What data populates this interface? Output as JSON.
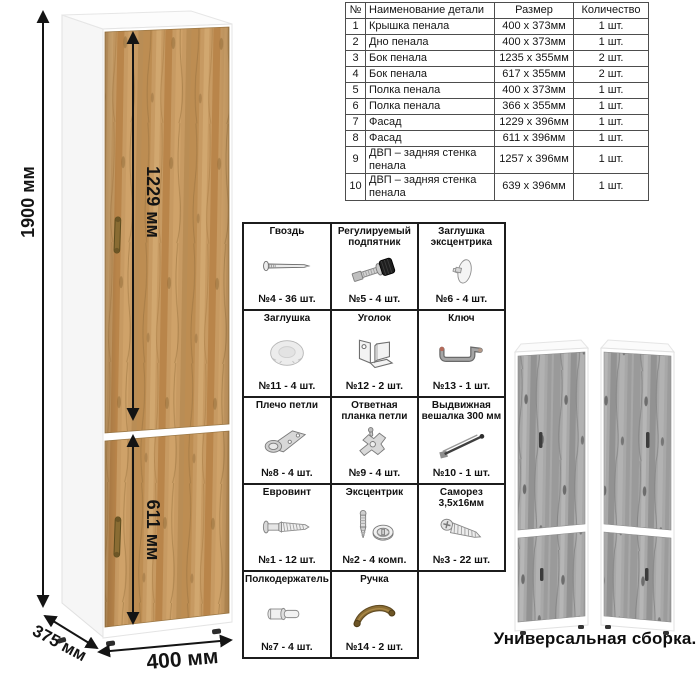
{
  "parts_table": {
    "headers": [
      "№",
      "Наименование детали",
      "Размер",
      "Количество"
    ],
    "rows": [
      [
        "1",
        "Крышка пенала",
        "400 х 373мм",
        "1 шт."
      ],
      [
        "2",
        "Дно пенала",
        "400 х 373мм",
        "1 шт."
      ],
      [
        "3",
        "Бок пенала",
        "1235 х 355мм",
        "2 шт."
      ],
      [
        "4",
        "Бок пенала",
        "617 х 355мм",
        "2 шт."
      ],
      [
        "5",
        "Полка пенала",
        "400 х 373мм",
        "1 шт."
      ],
      [
        "6",
        "Полка пенала",
        "366 х 355мм",
        "1 шт."
      ],
      [
        "7",
        "Фасад",
        "1229 х 396мм",
        "1 шт."
      ],
      [
        "8",
        "Фасад",
        "611 х 396мм",
        "1 шт."
      ],
      [
        "9",
        "ДВП – задняя стенка пенала",
        "1257 х 396мм",
        "1 шт."
      ],
      [
        "10",
        "ДВП – задняя стенка пенала",
        "639 х 396мм",
        "1 шт."
      ]
    ]
  },
  "hardware": {
    "items": [
      {
        "name": "Гвоздь",
        "qty": "№4 - 36 шт.",
        "icon": "nail-icon"
      },
      {
        "name": "Регулируемый подпятник",
        "qty": "№5 - 4 шт.",
        "icon": "adjustable-foot-icon"
      },
      {
        "name": "Заглушка эксцентрика",
        "qty": "№6 - 4 шт.",
        "icon": "cam-cap-icon"
      },
      {
        "name": "Заглушка",
        "qty": "№11 - 4 шт.",
        "icon": "cover-cap-icon"
      },
      {
        "name": "Уголок",
        "qty": "№12 - 2 шт.",
        "icon": "corner-bracket-icon"
      },
      {
        "name": "Ключ",
        "qty": "№13 - 1 шт.",
        "icon": "hex-key-icon"
      },
      {
        "name": "Плечо петли",
        "qty": "№8 - 4 шт.",
        "icon": "hinge-arm-icon"
      },
      {
        "name": "Ответная планка петли",
        "qty": "№9 - 4 шт.",
        "icon": "hinge-plate-icon"
      },
      {
        "name": "Выдвижная вешалка 300 мм",
        "qty": "№10 - 1 шт.",
        "icon": "pullout-hanger-icon"
      },
      {
        "name": "Евровинт",
        "qty": "№1 - 12 шт.",
        "icon": "euro-screw-icon"
      },
      {
        "name": "Эксцентрик",
        "qty": "№2 - 4 комп.",
        "icon": "cam-lock-icon"
      },
      {
        "name": "Саморез 3,5х16мм",
        "qty": "№3 - 22 шт.",
        "icon": "self-tapping-screw-icon"
      },
      {
        "name": "Полкодержатель",
        "qty": "№7 - 4 шт.",
        "icon": "shelf-pin-icon"
      },
      {
        "name": "Ручка",
        "qty": "№14 - 2 шт.",
        "icon": "handle-icon"
      }
    ]
  },
  "drawing": {
    "dim_height": "1900 мм",
    "dim_upper_door": "1229 мм",
    "dim_lower_door": "611 мм",
    "dim_width": "400 мм",
    "dim_depth": "375 мм"
  },
  "variants": {
    "caption": "Универсальная сборка."
  },
  "colors": {
    "oak_wood": "#c79a62",
    "gray_wood": "#a8a8a8",
    "carcass_white": "#ffffff",
    "dimension_ink": "#141414",
    "table_border": "#4d4d4d",
    "grid_border": "#1c1c1c",
    "handle_bronze": "#8a6c33"
  }
}
